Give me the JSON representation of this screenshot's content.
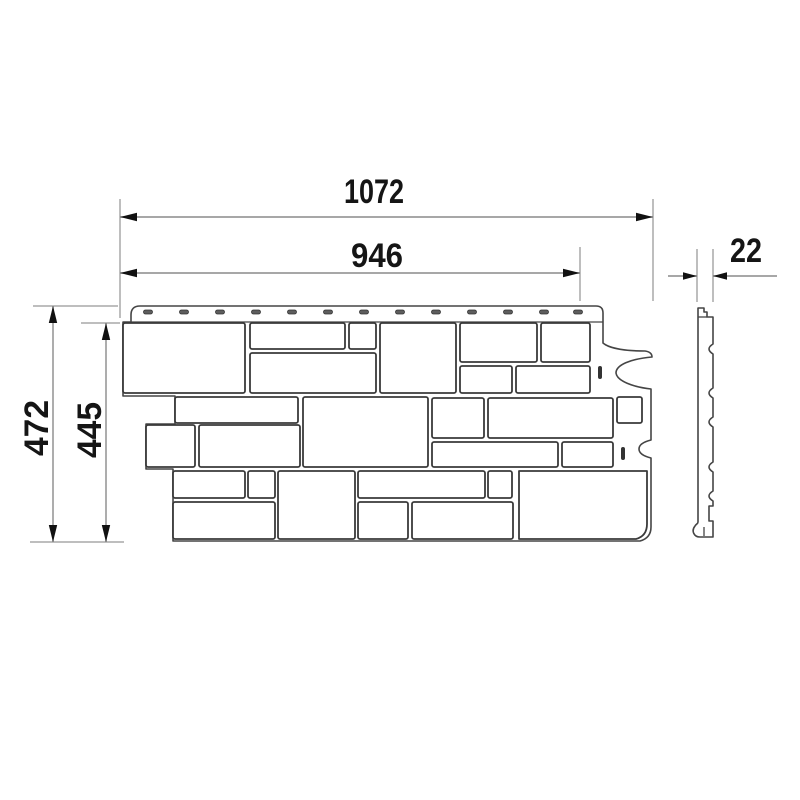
{
  "drawing": {
    "title": "Facade cladding panel — dimensioned technical drawing",
    "views": {
      "front": "panel front view with stone blocks",
      "side": "panel edge profile"
    },
    "dimensions": {
      "overall_width": "1072",
      "exposed_width": "946",
      "thickness": "22",
      "overall_height": "472",
      "exposed_height": "445"
    },
    "colors": {
      "background": "#ffffff",
      "dimension_line": "#8a8a8a",
      "ink": "#151515",
      "panel_line": "#3a3a3a"
    }
  }
}
